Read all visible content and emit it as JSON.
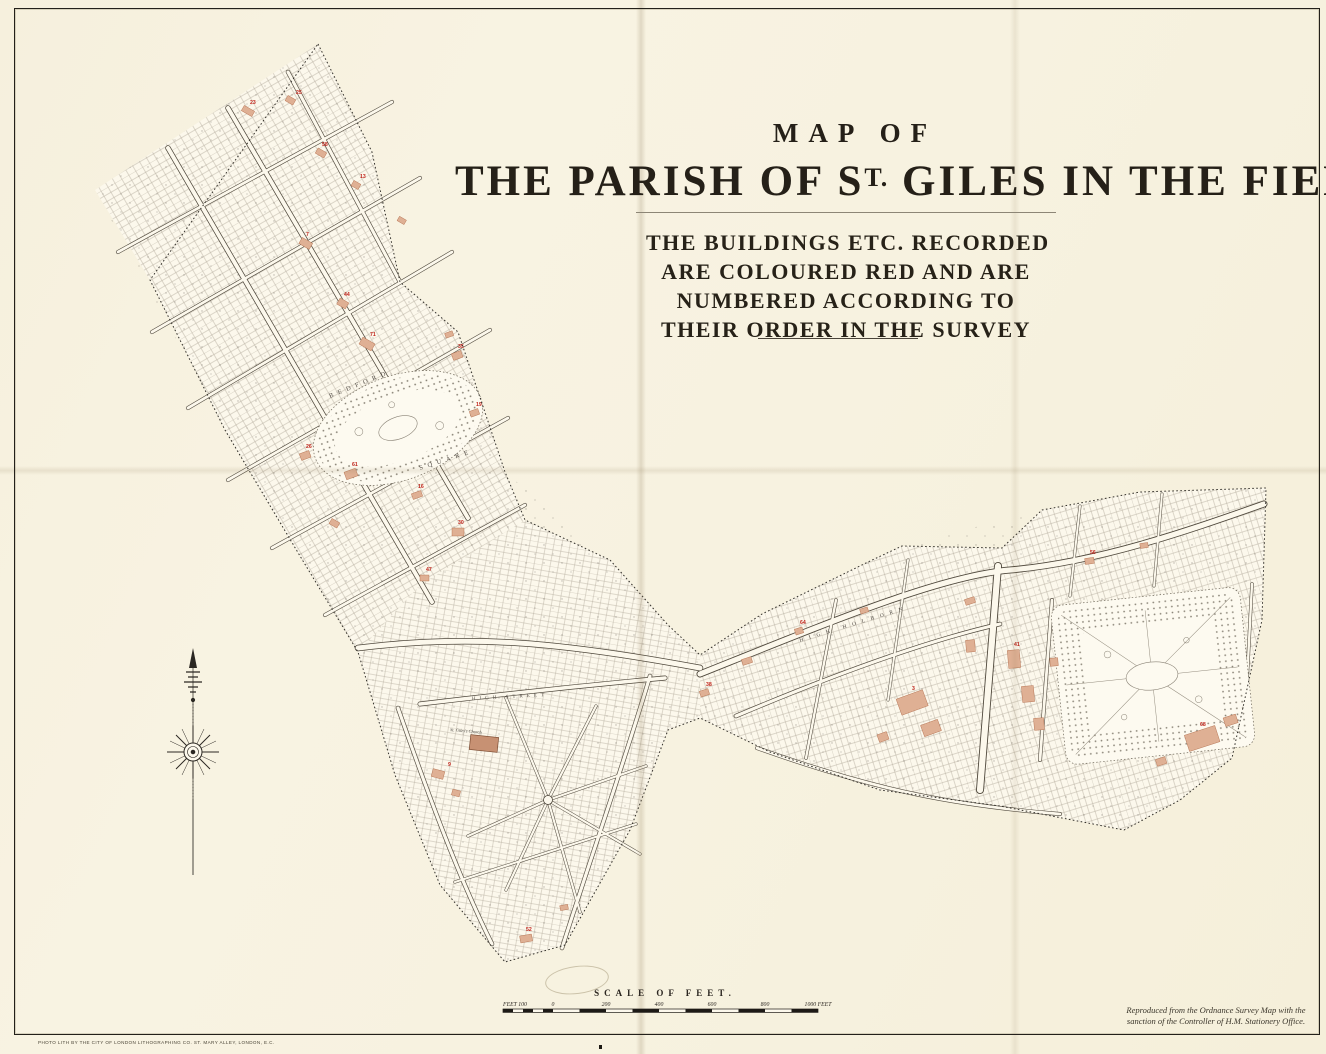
{
  "title": {
    "map_of": "MAP OF",
    "main_pre": "THE PARISH OF S",
    "main_sup": "T.",
    "main_post": " GILES IN THE FIELDS."
  },
  "note": {
    "lines": [
      "THE BUILDINGS ETC. RECORDED",
      "ARE COLOURED RED AND ARE",
      "NUMBERED ACCORDING TO",
      "THEIR ORDER IN THE SURVEY"
    ]
  },
  "scale_bar": {
    "title": "SCALE OF FEET.",
    "labels": [
      "FEET 100",
      "0",
      "200",
      "400",
      "600",
      "800",
      "1000 FEET"
    ]
  },
  "credits": {
    "os_line1": "Reproduced from the Ordnance Survey Map with the",
    "os_line2": "sanction of the Controller of H.M. Stationery Office.",
    "imprint": "PHOTO LITH BY THE CITY OF LONDON LITHOGRAPHING CO. ST. MARY ALLEY, LONDON, E.C."
  },
  "map": {
    "labels": {
      "bedford": "BEDFORD",
      "square": "SQUARE",
      "high_street": "HIGH STREET",
      "high_holborn": "HIGH HOLBORN",
      "church": "St. Giles's Church"
    },
    "red_numbers": [
      "23",
      "25",
      "58",
      "13",
      "7",
      "44",
      "71",
      "26",
      "35",
      "19",
      "61",
      "16",
      "30",
      "47",
      "9",
      "52",
      "38",
      "64",
      "3",
      "41",
      "56",
      "68"
    ]
  },
  "colors": {
    "paper": "#f7f2e0",
    "map_fill": "#fcf8ec",
    "building_red": "#dfb094",
    "number_red": "#c0251c",
    "ink": "#2b2620"
  }
}
